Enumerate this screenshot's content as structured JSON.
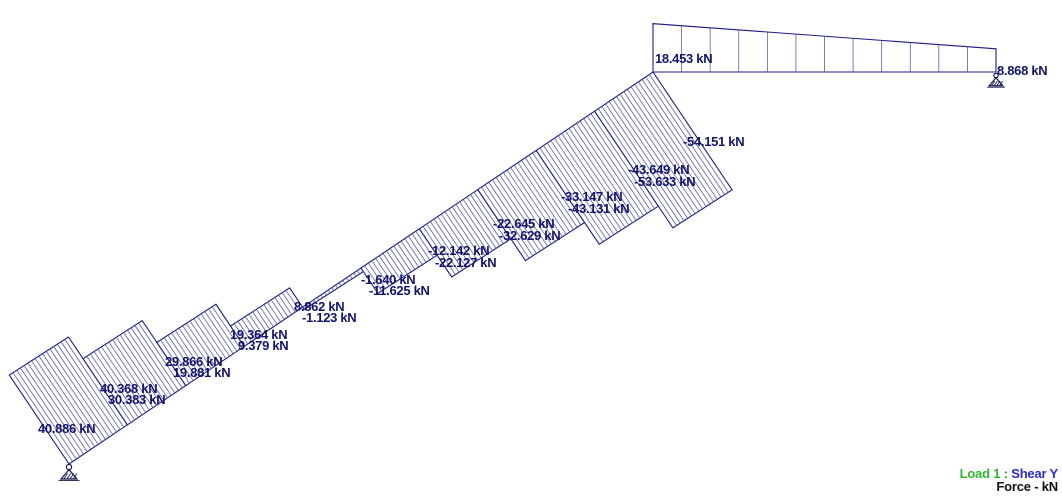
{
  "legend": {
    "load": "Load 1",
    "separator": " : ",
    "result": "Shear Y",
    "unit_line": "Force - kN",
    "load_color": "#2fb52f",
    "separator_color": "#2f8f2f",
    "result_color": "#2a2ad0",
    "unit_color": "#111111"
  },
  "chart_data": {
    "type": "shear_force_diagram",
    "unit": "kN",
    "load_case": "Load 1",
    "result_component": "Shear Y",
    "line_color": "#1c1c86",
    "hatch_color": "#5252a8",
    "label_color": "#14146a",
    "scale_px_per_kn": 2.62,
    "stringer": {
      "start": [
        69,
        464
      ],
      "end": [
        653,
        72
      ],
      "sections_per_segment": 16,
      "segments": [
        {
          "v1": 40.886,
          "v2": 40.368
        },
        {
          "v1": 30.383,
          "v2": 29.866
        },
        {
          "v1": 19.881,
          "v2": 19.364
        },
        {
          "v1": 9.379,
          "v2": 8.862
        },
        {
          "v1": -1.123,
          "v2": -1.64
        },
        {
          "v1": -11.625,
          "v2": -12.142
        },
        {
          "v1": -22.127,
          "v2": -22.645
        },
        {
          "v1": -32.629,
          "v2": -33.147
        },
        {
          "v1": -43.131,
          "v2": -43.649
        },
        {
          "v1": -53.633,
          "v2": -54.151
        }
      ]
    },
    "beam": {
      "start": [
        653,
        72
      ],
      "end": [
        996,
        72
      ],
      "sections": 12,
      "v1": 18.453,
      "v2": 8.868
    },
    "supports": [
      {
        "type": "pinned",
        "x": 69,
        "y": 464,
        "size": 1.0
      },
      {
        "type": "pinned",
        "x": 996,
        "y": 73,
        "size": 0.85
      }
    ],
    "labels": [
      {
        "text": "40.886 kN",
        "x": 38,
        "y": 433
      },
      {
        "text": "40.368 kN",
        "x": 100,
        "y": 393
      },
      {
        "text": "30.383 kN",
        "x": 108,
        "y": 404
      },
      {
        "text": "29.866 kN",
        "x": 165,
        "y": 366
      },
      {
        "text": "19.881 kN",
        "x": 173,
        "y": 377
      },
      {
        "text": "19.364 kN",
        "x": 230,
        "y": 339
      },
      {
        "text": "9.379 kN",
        "x": 238,
        "y": 350
      },
      {
        "text": "8.862 kN",
        "x": 294,
        "y": 311
      },
      {
        "text": "-1.123 kN",
        "x": 302,
        "y": 322
      },
      {
        "text": "-1.640 kN",
        "x": 361,
        "y": 284
      },
      {
        "text": "-11.625 kN",
        "x": 369,
        "y": 295
      },
      {
        "text": "-12.142 kN",
        "x": 428,
        "y": 255
      },
      {
        "text": "-22.127 kN",
        "x": 435,
        "y": 267
      },
      {
        "text": "-22.645 kN",
        "x": 493,
        "y": 228
      },
      {
        "text": "-32.629 kN",
        "x": 499,
        "y": 240
      },
      {
        "text": "-33.147 kN",
        "x": 561,
        "y": 201
      },
      {
        "text": "-43.131 kN",
        "x": 568,
        "y": 213
      },
      {
        "text": "-43.649 kN",
        "x": 628,
        "y": 174
      },
      {
        "text": "-53.633 kN",
        "x": 634,
        "y": 186
      },
      {
        "text": "-54.151 kN",
        "x": 683,
        "y": 146
      },
      {
        "text": "18.453 kN",
        "x": 655,
        "y": 63
      },
      {
        "text": "8.868 kN",
        "x": 997,
        "y": 75
      }
    ]
  }
}
